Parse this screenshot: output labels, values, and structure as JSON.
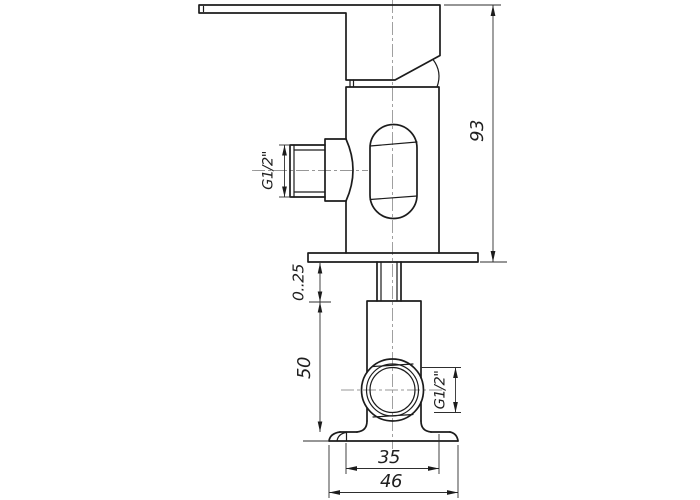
{
  "drawing": {
    "kind": "technical-drawing",
    "subject": "wall-mounted shower mixer valve, side elevation with section details",
    "colors": {
      "background": "#ffffff",
      "object_line": "#1c1c1c",
      "dimension_line": "#2e2e2e",
      "center_line": "#979797"
    },
    "labels": {
      "overall_height": "93",
      "wall_depth_range": "0..25",
      "lower_body_height": "50",
      "body_width": "35",
      "flange_width": "46",
      "side_thread": "G1/2\"",
      "bottom_thread": "G1/2\""
    }
  }
}
